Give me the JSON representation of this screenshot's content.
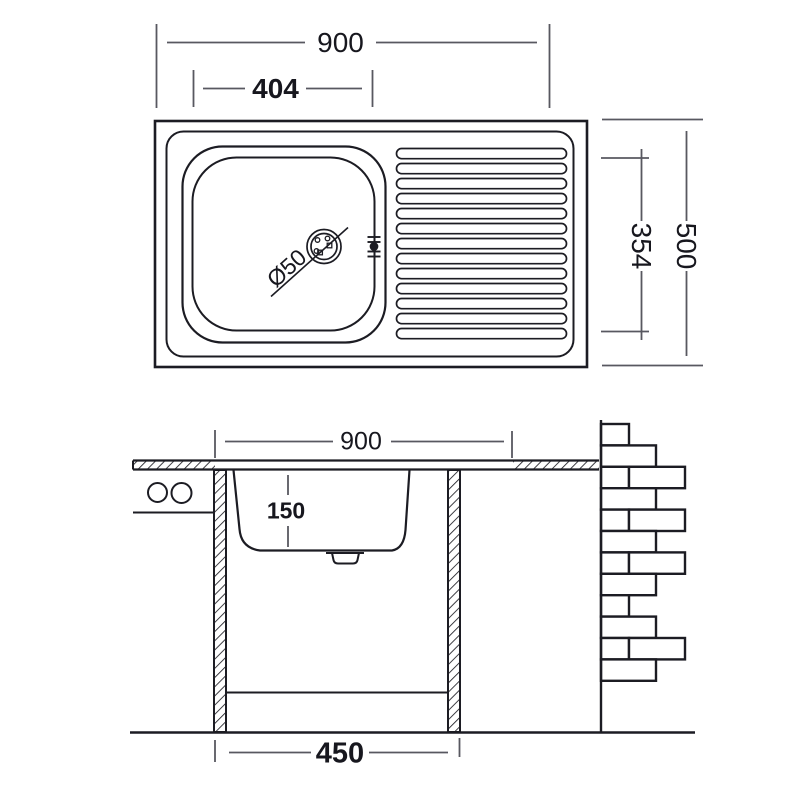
{
  "drawing": {
    "colors": {
      "background": "#ffffff",
      "object_line": "#1c1c23",
      "dimension_line": "#585860",
      "text": "#17171e"
    },
    "top_view": {
      "overall_width": "900",
      "bowl_width": "404",
      "overall_depth": "500",
      "bowl_depth": "354",
      "drain_diameter": "Ø50"
    },
    "section_view": {
      "overall_width": "900",
      "bowl_depth": "150",
      "base_width": "450"
    }
  }
}
